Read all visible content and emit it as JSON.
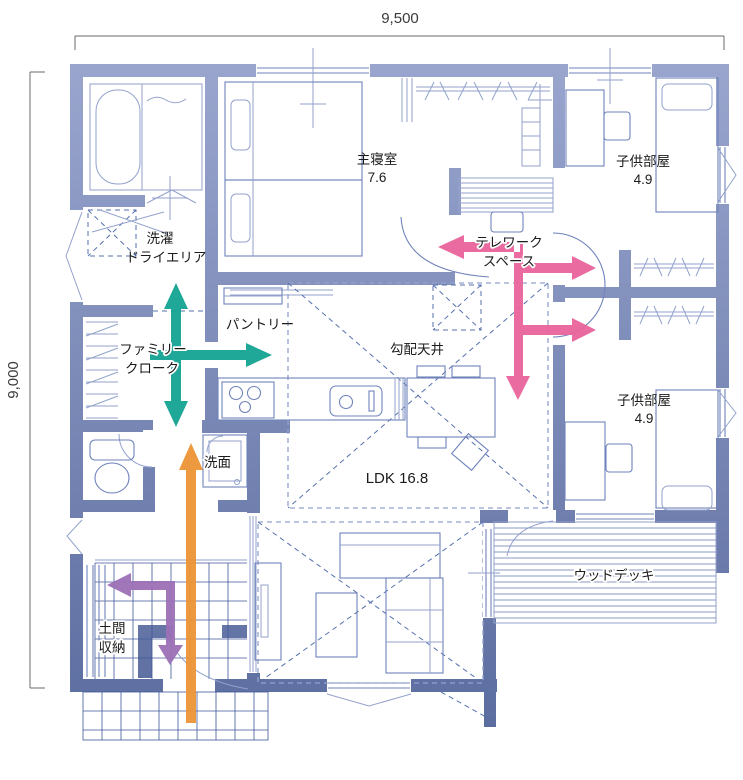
{
  "dimensions": {
    "top": "9,500",
    "left": "9,000"
  },
  "rooms": {
    "master": {
      "name": "主寝室",
      "area": "7.6"
    },
    "kids1": {
      "name": "子供部屋",
      "area": "4.9"
    },
    "kids2": {
      "name": "子供部屋",
      "area": "4.9"
    },
    "telework": {
      "line1": "テレワーク",
      "line2": "スペース"
    },
    "sloped_ceiling": "勾配天井",
    "pantry": "パントリー",
    "family_closet": {
      "line1": "ファミリー",
      "line2": "クローク"
    },
    "laundry": {
      "line1": "洗濯",
      "line2": "ドライエリア"
    },
    "washroom": "洗面",
    "ldk": "LDK 16.8",
    "doma": {
      "line1": "土間",
      "line2": "収納"
    },
    "deck": "ウッドデッキ"
  },
  "flow_arrows": [
    {
      "id": "family-closet-flow",
      "color": "#13a392"
    },
    {
      "id": "telework-flow",
      "color": "#e8639a"
    },
    {
      "id": "entrance-flow",
      "color": "#ec9336"
    },
    {
      "id": "doma-flow",
      "color": "#9c70b6"
    }
  ],
  "colors": {
    "wall_top": "#9aa6ce",
    "wall_bottom": "#5a6b9e",
    "line": "#6f83bb",
    "line_light": "#93a2cc",
    "dash": "#5470ad",
    "tile": "#41589a",
    "deck": "#8b99c6",
    "text": "#1b1b1b",
    "dim": "#6a6a6a",
    "teal": "#13a392",
    "pink": "#e8639a",
    "orange": "#ec9336",
    "purple": "#9c70b6",
    "bg": "#ffffff"
  }
}
